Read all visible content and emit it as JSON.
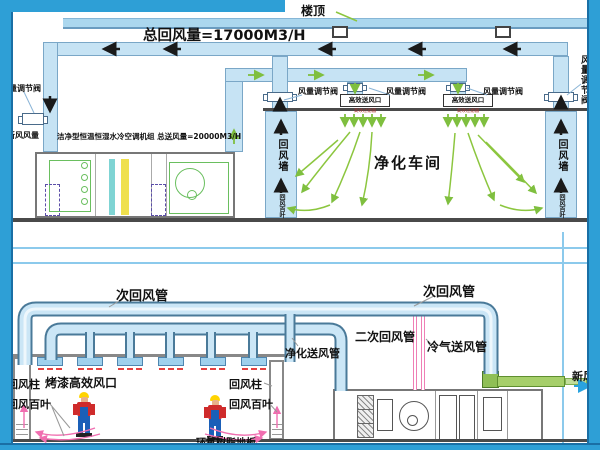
{
  "top": {
    "roof": "楼顶",
    "title": "总回风量=17000M3/H",
    "valve": "风量调节阀",
    "fresh_air_volume": "新风风量",
    "ahu": "洁净型恒温恒湿水冷空调机组  总送风量=20000M3/H",
    "hepa_outlet": "高效送风口",
    "hepa_outlet_sub": "高效过滤器",
    "cleanroom": "净化车间",
    "return_wall": "回风墙",
    "return_louver": "回风百叶"
  },
  "bottom": {
    "secondary_return": "次回风管",
    "secondary_return_2": "二次回风管",
    "cold_supply": "冷气送风管",
    "purified_supply": "净化送风管",
    "fresh_air": "新风",
    "return_column": "回风柱",
    "hepa_paint_outlet": "烤漆高效风口",
    "return_louver": "回风百叶",
    "epoxy_floor": "环氧树脂地板"
  },
  "colors": {
    "frame_blue": "#2E9FD6",
    "duct_fill": "#C6E3F4",
    "duct_border": "#7AA7C7",
    "pipe_outline": "#4A7A99",
    "airflow_green": "#8CC63F",
    "pink_arrow": "#F06EB0",
    "fresh_duct_green": "#A6CF6A",
    "cold_pipe_pink": "#EF7FB5",
    "floor_gray": "#4A4A4A",
    "red_marks": "#E34040"
  }
}
